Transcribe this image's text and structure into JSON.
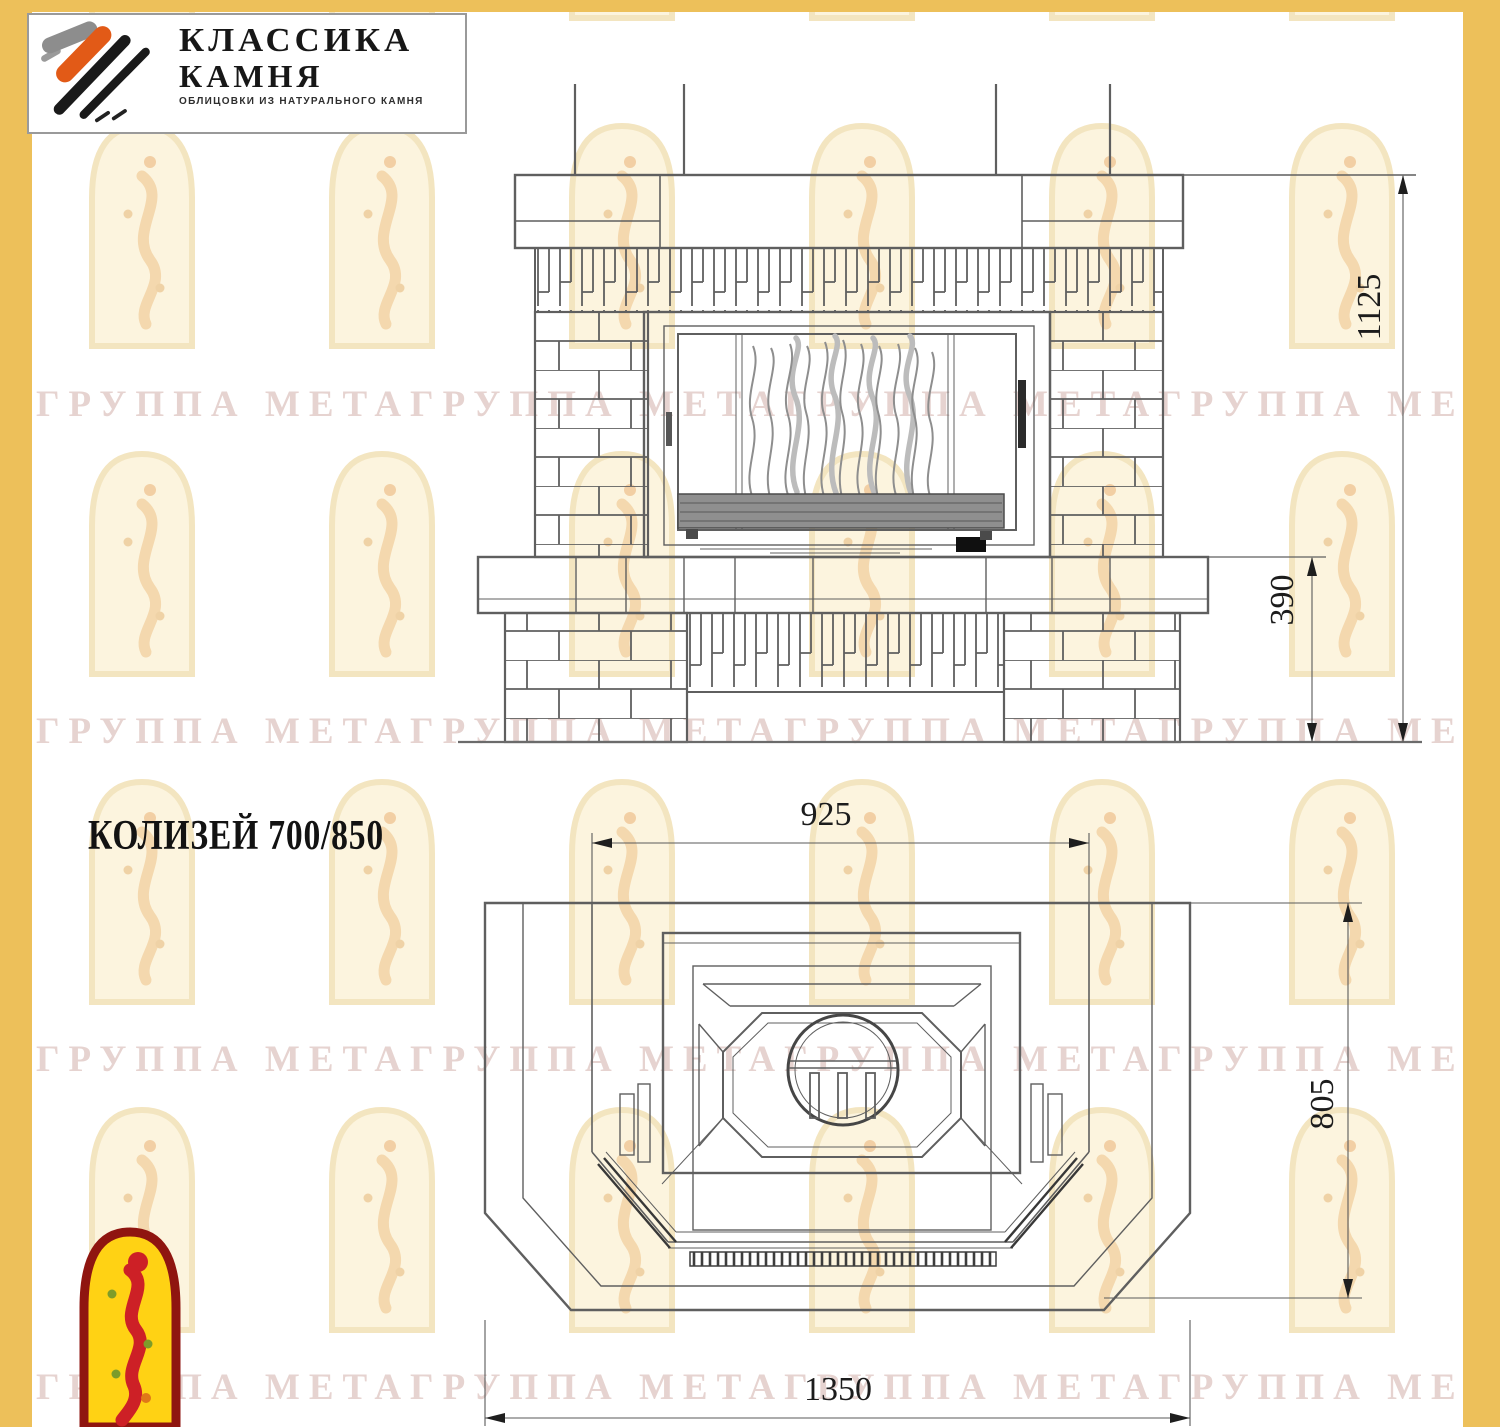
{
  "page": {
    "width": 1500,
    "height": 1427,
    "colors": {
      "side_band": "#edc05a",
      "drawing_line": "#5f5f5f",
      "dim_text": "#1c1c1c",
      "watermark_text": "#c49690",
      "watermark_arch_fill": "#fcf4de",
      "corner_logo_yellow": "#ffd214",
      "corner_logo_red": "#cd2026"
    }
  },
  "logo": {
    "brand_line1": "КЛАССИКА",
    "brand_line2": "КАМНЯ",
    "tagline": "ОБЛИЦОВКИ ИЗ НАТУРАЛЬНОГО КАМНЯ",
    "mark_icon": "brush-strokes-icon"
  },
  "watermark": {
    "row_text": "ГРУППА МЕТАГРУППА МЕТАГРУППА МЕТАГРУППА МЕТА",
    "arch_icon": "arched-window-figure-icon"
  },
  "drawing": {
    "model_title": "КОЛИЗЕЙ 700/850",
    "front_view": {
      "name": "front-elevation",
      "dim_total_height": "1125",
      "dim_base_height": "390"
    },
    "plan_view": {
      "name": "top-plan",
      "dim_firebox_width": "925",
      "dim_depth": "805",
      "dim_overall_width": "1350"
    }
  },
  "corner_logo": {
    "icon": "yellow-arch-figure-icon"
  }
}
